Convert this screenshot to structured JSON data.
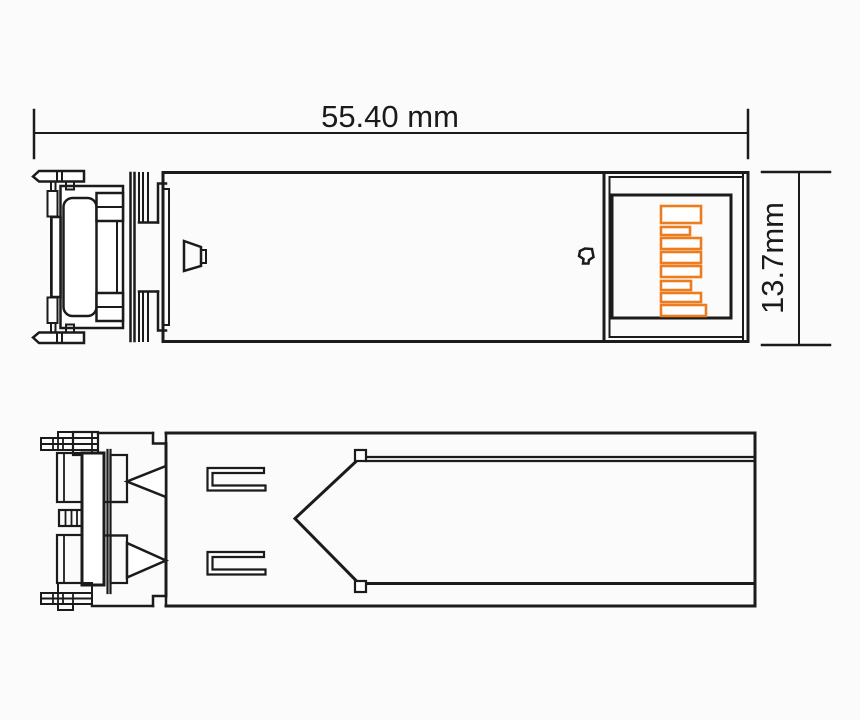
{
  "figure": {
    "width_dimension_label": "55.40 mm",
    "height_dimension_label": "13.7mm"
  },
  "colors": {
    "line": "#1b1b1b",
    "pad_accent": "#ED7C1F",
    "background": "#fbfbfb"
  }
}
